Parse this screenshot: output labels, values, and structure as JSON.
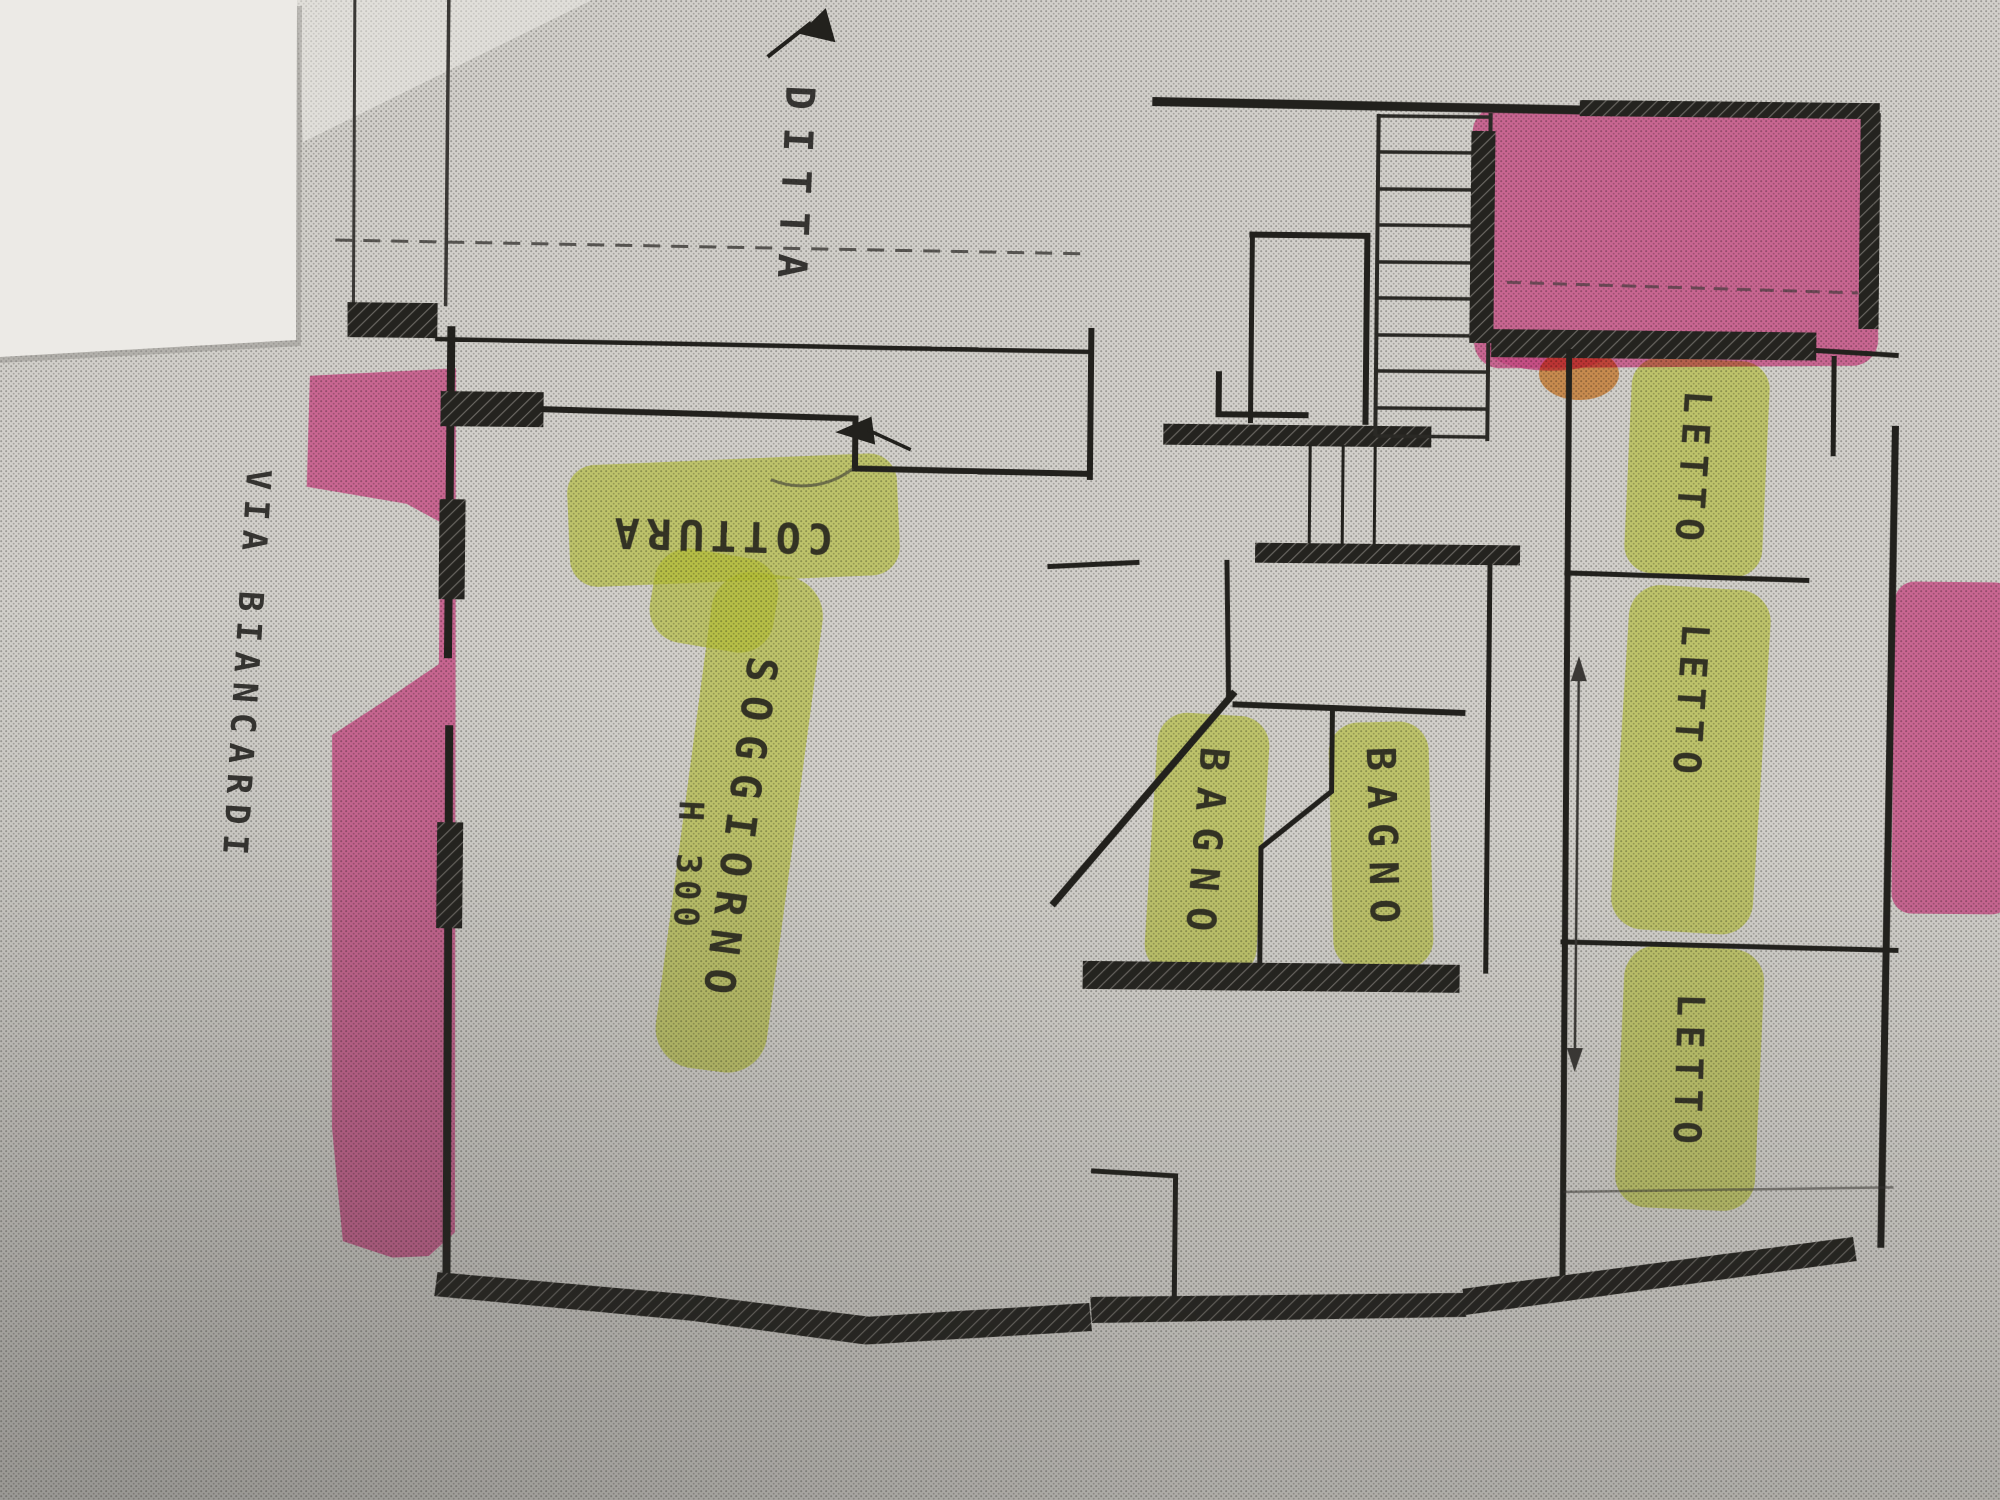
{
  "document": {
    "kind": "scanned floor plan photo with highlighter annotations",
    "street_label": "VIA BIANCARDI",
    "owner_label": "DITTA",
    "height_note": "H 300"
  },
  "rooms": [
    {
      "id": "cottura",
      "label": "COTTURA",
      "highlight": "#d9e73b"
    },
    {
      "id": "soggiorno",
      "label": "SOGGIORNO",
      "highlight": "#d9e73b"
    },
    {
      "id": "bagno-1",
      "label": "BAGNO",
      "highlight": "#d9e73b"
    },
    {
      "id": "bagno-2",
      "label": "BAGNO",
      "highlight": "#d9e73b"
    },
    {
      "id": "letto-1",
      "label": "LETTO",
      "highlight": "#d9e73b"
    },
    {
      "id": "letto-2",
      "label": "LETTO",
      "highlight": "#d9e73b"
    },
    {
      "id": "letto-3",
      "label": "LETTO",
      "highlight": "#d9e73b"
    }
  ],
  "colors": {
    "paper": "#d2d0cb",
    "white_sheet": "#eceae6",
    "ink": "#22211d",
    "highlight_green": "#d9e73b",
    "highlight_pink": "#f158a3",
    "overlap_orange": "#f0953c"
  }
}
